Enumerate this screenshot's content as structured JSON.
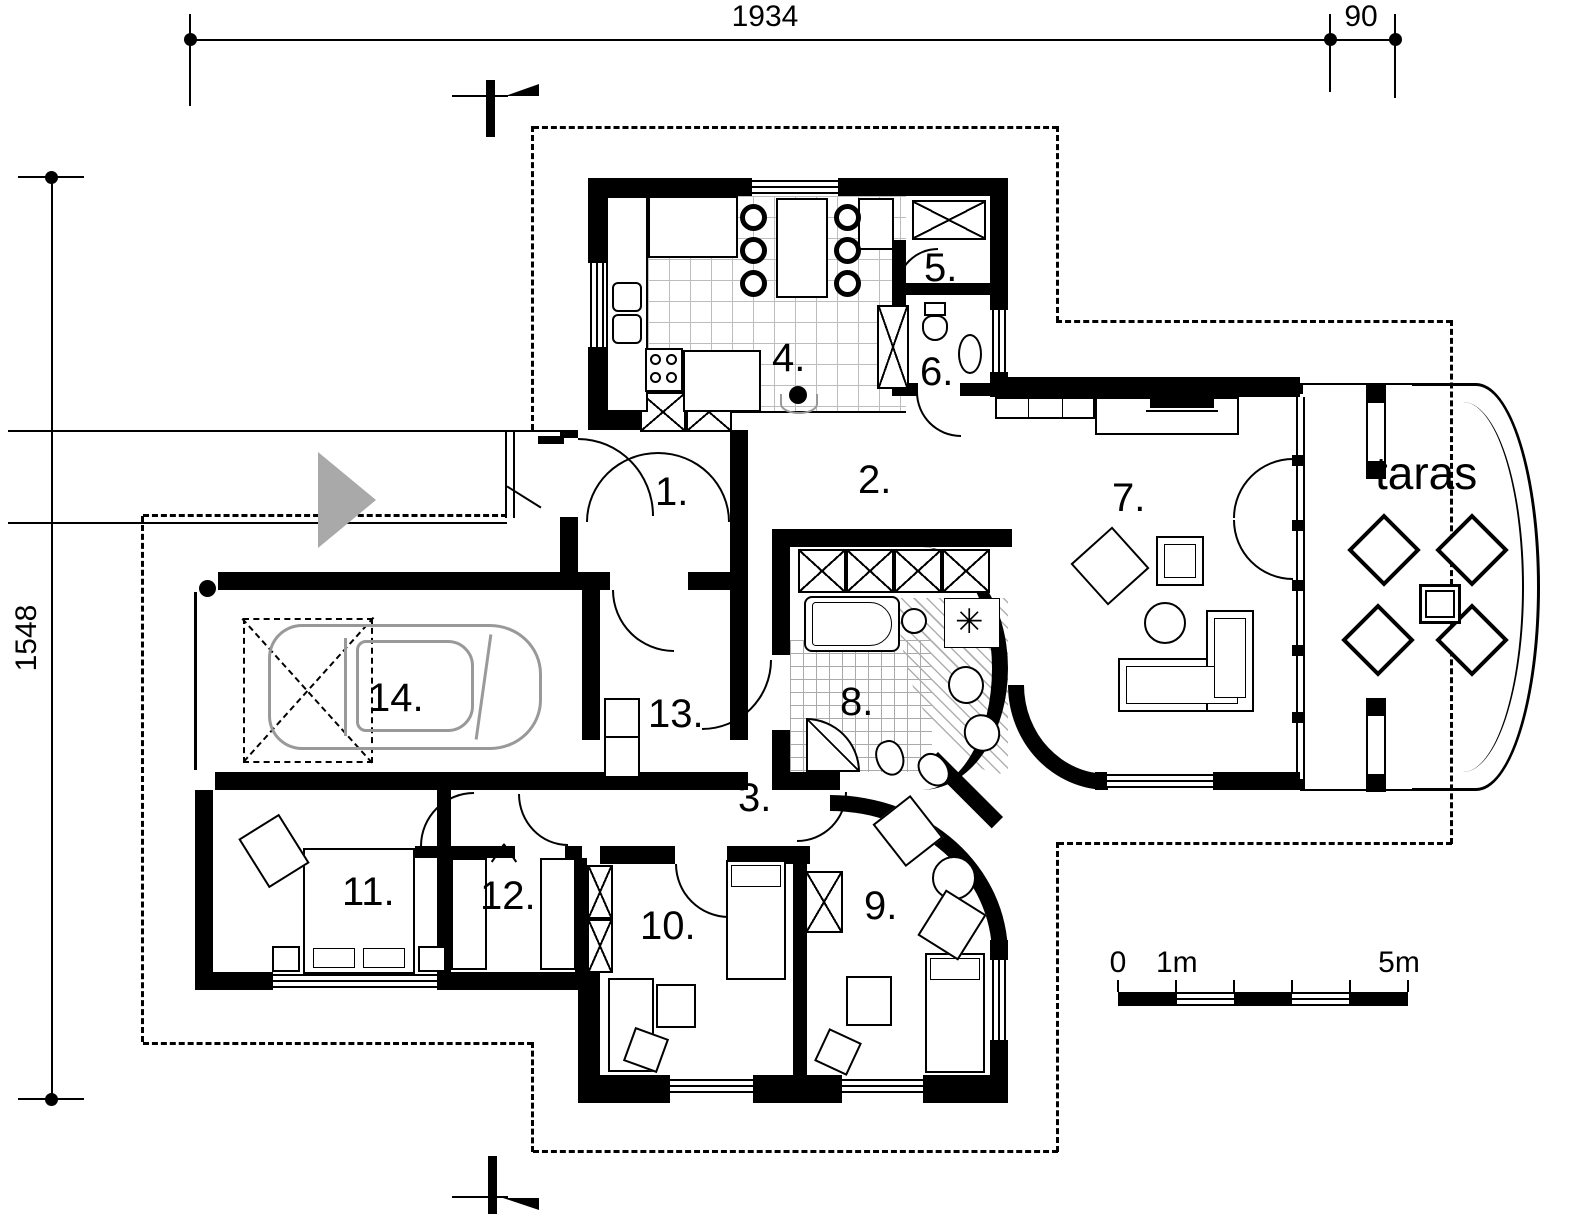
{
  "plan": {
    "title": "single-storey house floor plan",
    "rooms": [
      {
        "number": "1."
      },
      {
        "number": "2."
      },
      {
        "number": "3."
      },
      {
        "number": "4."
      },
      {
        "number": "5."
      },
      {
        "number": "6."
      },
      {
        "number": "7."
      },
      {
        "number": "8."
      },
      {
        "number": "9."
      },
      {
        "number": "10."
      },
      {
        "number": "11."
      },
      {
        "number": "12."
      },
      {
        "number": "13."
      },
      {
        "number": "14."
      }
    ],
    "terrace_label": "taras",
    "dimensions": {
      "top_width": "1934",
      "top_right_offset": "90",
      "left_height": "1548"
    },
    "scale_bar": {
      "zero": "0",
      "one_m": "1m",
      "five_m": "5m"
    },
    "icons": {
      "vent-star": "✳"
    },
    "colors": {
      "walls": "#000000",
      "paper": "#ffffff",
      "car_outline": "#999999",
      "driveway_arrow": "#a9a9a9",
      "tile_lines": "#bdbdbd"
    }
  }
}
